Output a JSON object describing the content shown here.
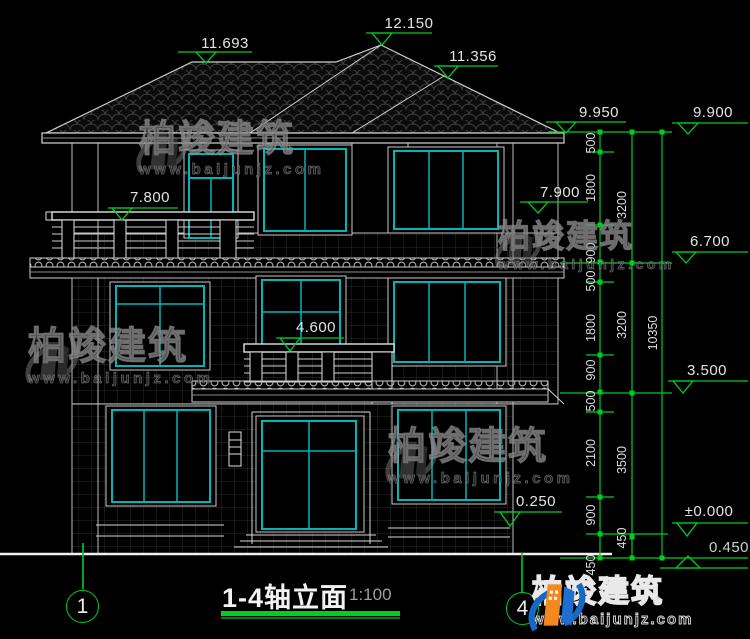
{
  "drawing": {
    "title": "1-4轴立面",
    "scale": "1:100",
    "axis_left": "1",
    "axis_right": "4"
  },
  "levels": {
    "ridge_left": "11.693",
    "ridge_main": "12.150",
    "ridge_right": "11.356",
    "eave_left": "9.950",
    "eave_right": "9.900",
    "balcony3": "7.800",
    "floor3_right": "7.900",
    "floor2_right": "6.700",
    "balcony2": "4.600",
    "floor1_right": "3.500",
    "porch": "0.250",
    "ground": "±0.000",
    "foundation": "0.450"
  },
  "dims": {
    "chain_inner": [
      "500",
      "1800",
      "900",
      "500",
      "1800",
      "900",
      "500",
      "2100",
      "900",
      "450"
    ],
    "chain_mid": [
      "3200",
      "3200",
      "3500",
      "450"
    ],
    "overall": "10350"
  },
  "watermark": {
    "brand": "柏竣建筑",
    "site": "www.baijunjz.com"
  },
  "logo": {
    "brand": "柏竣建筑",
    "site": "www.baijunjz.com"
  },
  "colors": {
    "dimension": "#00cc22",
    "window_frame": "#00b6b6",
    "line": "#d4d4d4",
    "background": "#000000"
  }
}
